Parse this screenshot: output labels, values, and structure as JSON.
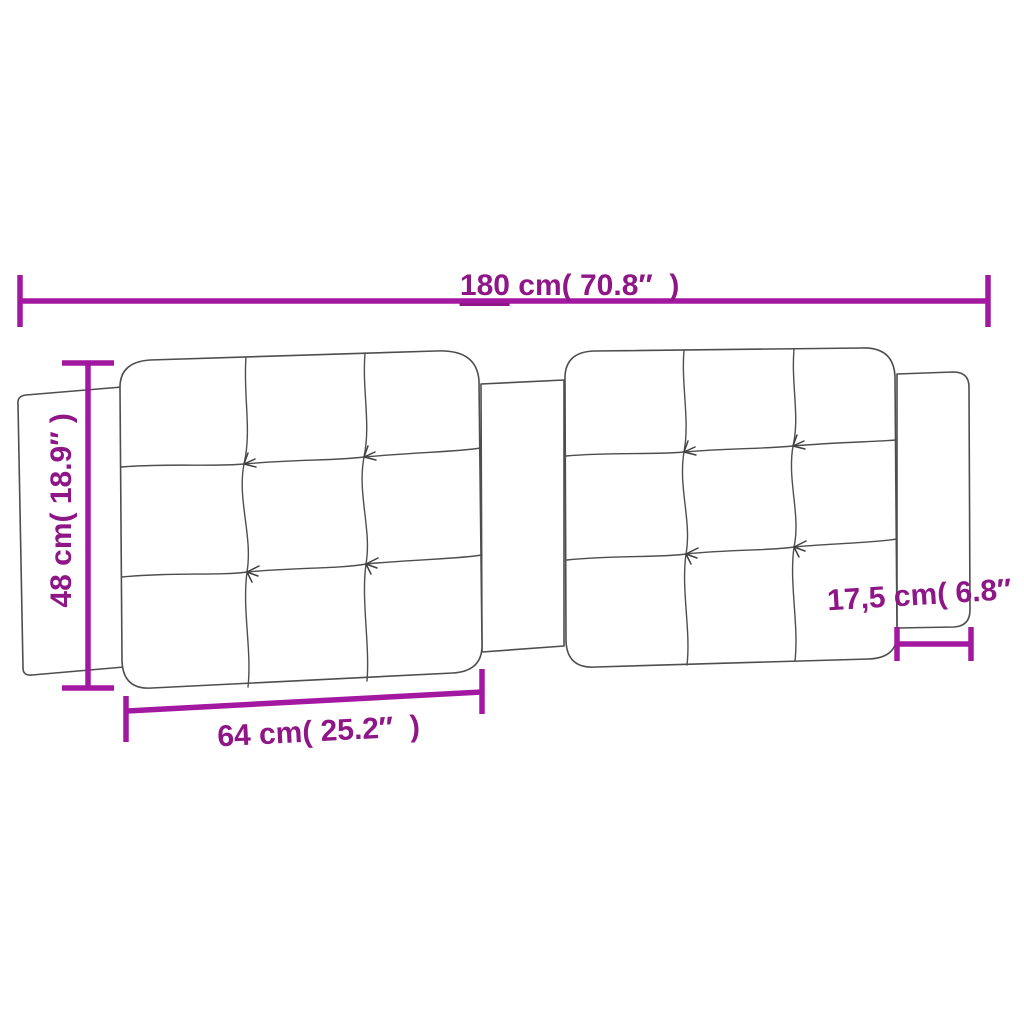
{
  "title": "Headboard cushion dimension diagram",
  "colors": {
    "background": "#FFFFFF",
    "dimension_line": "#A318A0",
    "dimension_text": "#8E1687",
    "drawing_outline": "#4E4E4E"
  },
  "product": {
    "name": "tufted-headboard-cushion",
    "panel_count": 2,
    "tufts_per_panel": 4,
    "side_flaps": 2
  },
  "dimensions": [
    {
      "id": "total-width",
      "value": "180",
      "rest": " cm( 70.8″  )",
      "position": "top",
      "orientation": "horizontal"
    },
    {
      "id": "height",
      "value": "48",
      "rest": " cm( 18.9″ )",
      "position": "left",
      "orientation": "vertical"
    },
    {
      "id": "cushion-panel-width",
      "value": "64",
      "rest": " cm( 25.2″  )",
      "position": "bottom-left",
      "orientation": "horizontal"
    },
    {
      "id": "side-flap-width",
      "value": "17,5",
      "rest": " cm( 6.8″  )",
      "position": "right",
      "orientation": "horizontal"
    }
  ]
}
